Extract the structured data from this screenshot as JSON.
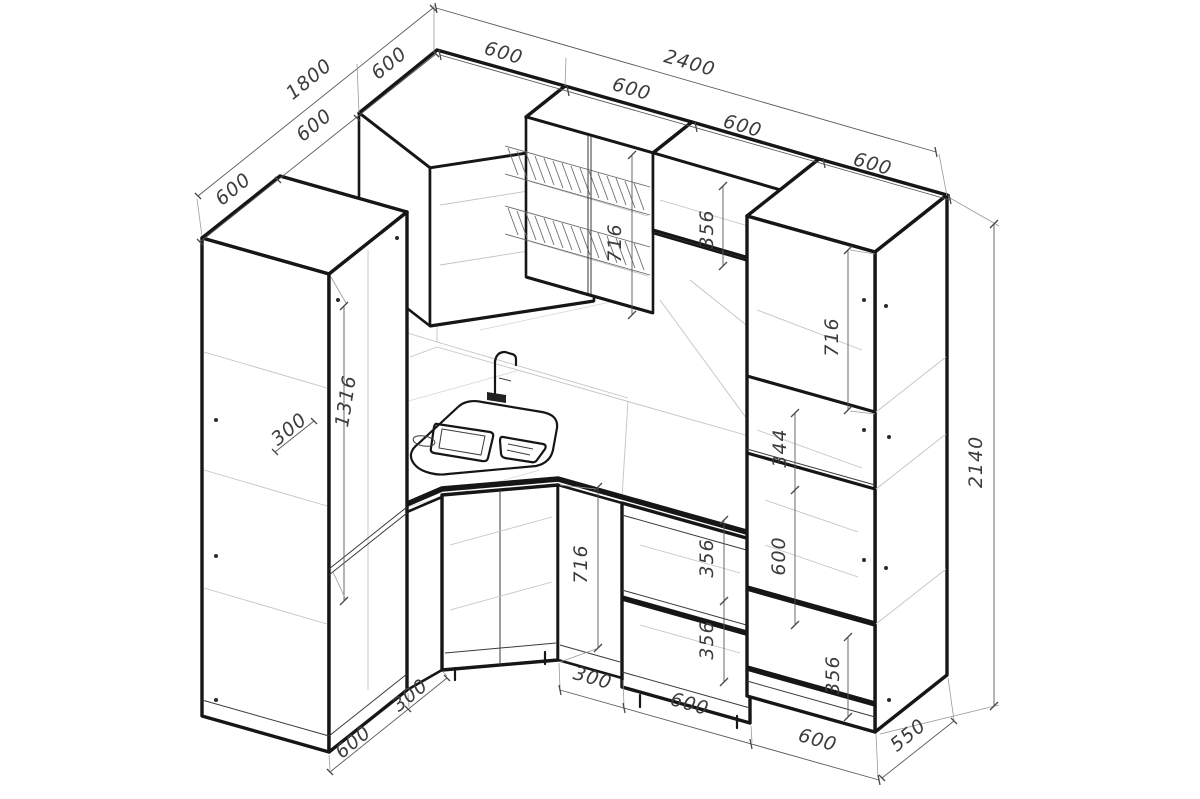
{
  "drawing": {
    "title": "Corner kitchen cabinets — isometric dimensioned drawing",
    "background": "#ffffff",
    "line_color": "#161616",
    "dim_color": "#3c3c3c"
  },
  "dims": [
    {
      "id": "wall-left-total",
      "label": "1800"
    },
    {
      "id": "wall-left-seg-1",
      "label": "600"
    },
    {
      "id": "wall-left-seg-2",
      "label": "600"
    },
    {
      "id": "wall-left-seg-3",
      "label": "600"
    },
    {
      "id": "wall-right-total",
      "label": "2400"
    },
    {
      "id": "wall-right-seg-1",
      "label": "600"
    },
    {
      "id": "wall-right-seg-2",
      "label": "600"
    },
    {
      "id": "wall-right-seg-3",
      "label": "600"
    },
    {
      "id": "wall-right-seg-4",
      "label": "600"
    },
    {
      "id": "total-height",
      "label": "2140"
    },
    {
      "id": "column-upper-cabinet",
      "label": "716"
    },
    {
      "id": "column-open-shelf",
      "label": "344"
    },
    {
      "id": "column-oven-cavity",
      "label": "600"
    },
    {
      "id": "column-bottom-drawer",
      "label": "356"
    },
    {
      "id": "dishrack-cabinet",
      "label": "716"
    },
    {
      "id": "small-wall-cabinet",
      "label": "356"
    },
    {
      "id": "tall-cabinet-door",
      "label": "1316"
    },
    {
      "id": "tall-cabinet-shelf",
      "label": "300"
    },
    {
      "id": "base-cabinet-height",
      "label": "716"
    },
    {
      "id": "drawer-1",
      "label": "356"
    },
    {
      "id": "drawer-2",
      "label": "356"
    },
    {
      "id": "bottom-tall-cabinet",
      "label": "600"
    },
    {
      "id": "bottom-narrow-base",
      "label": "300"
    },
    {
      "id": "bottom-corner-flank",
      "label": "300"
    },
    {
      "id": "bottom-drawer-base",
      "label": "600"
    },
    {
      "id": "bottom-column",
      "label": "600"
    },
    {
      "id": "column-depth",
      "label": "550"
    }
  ]
}
